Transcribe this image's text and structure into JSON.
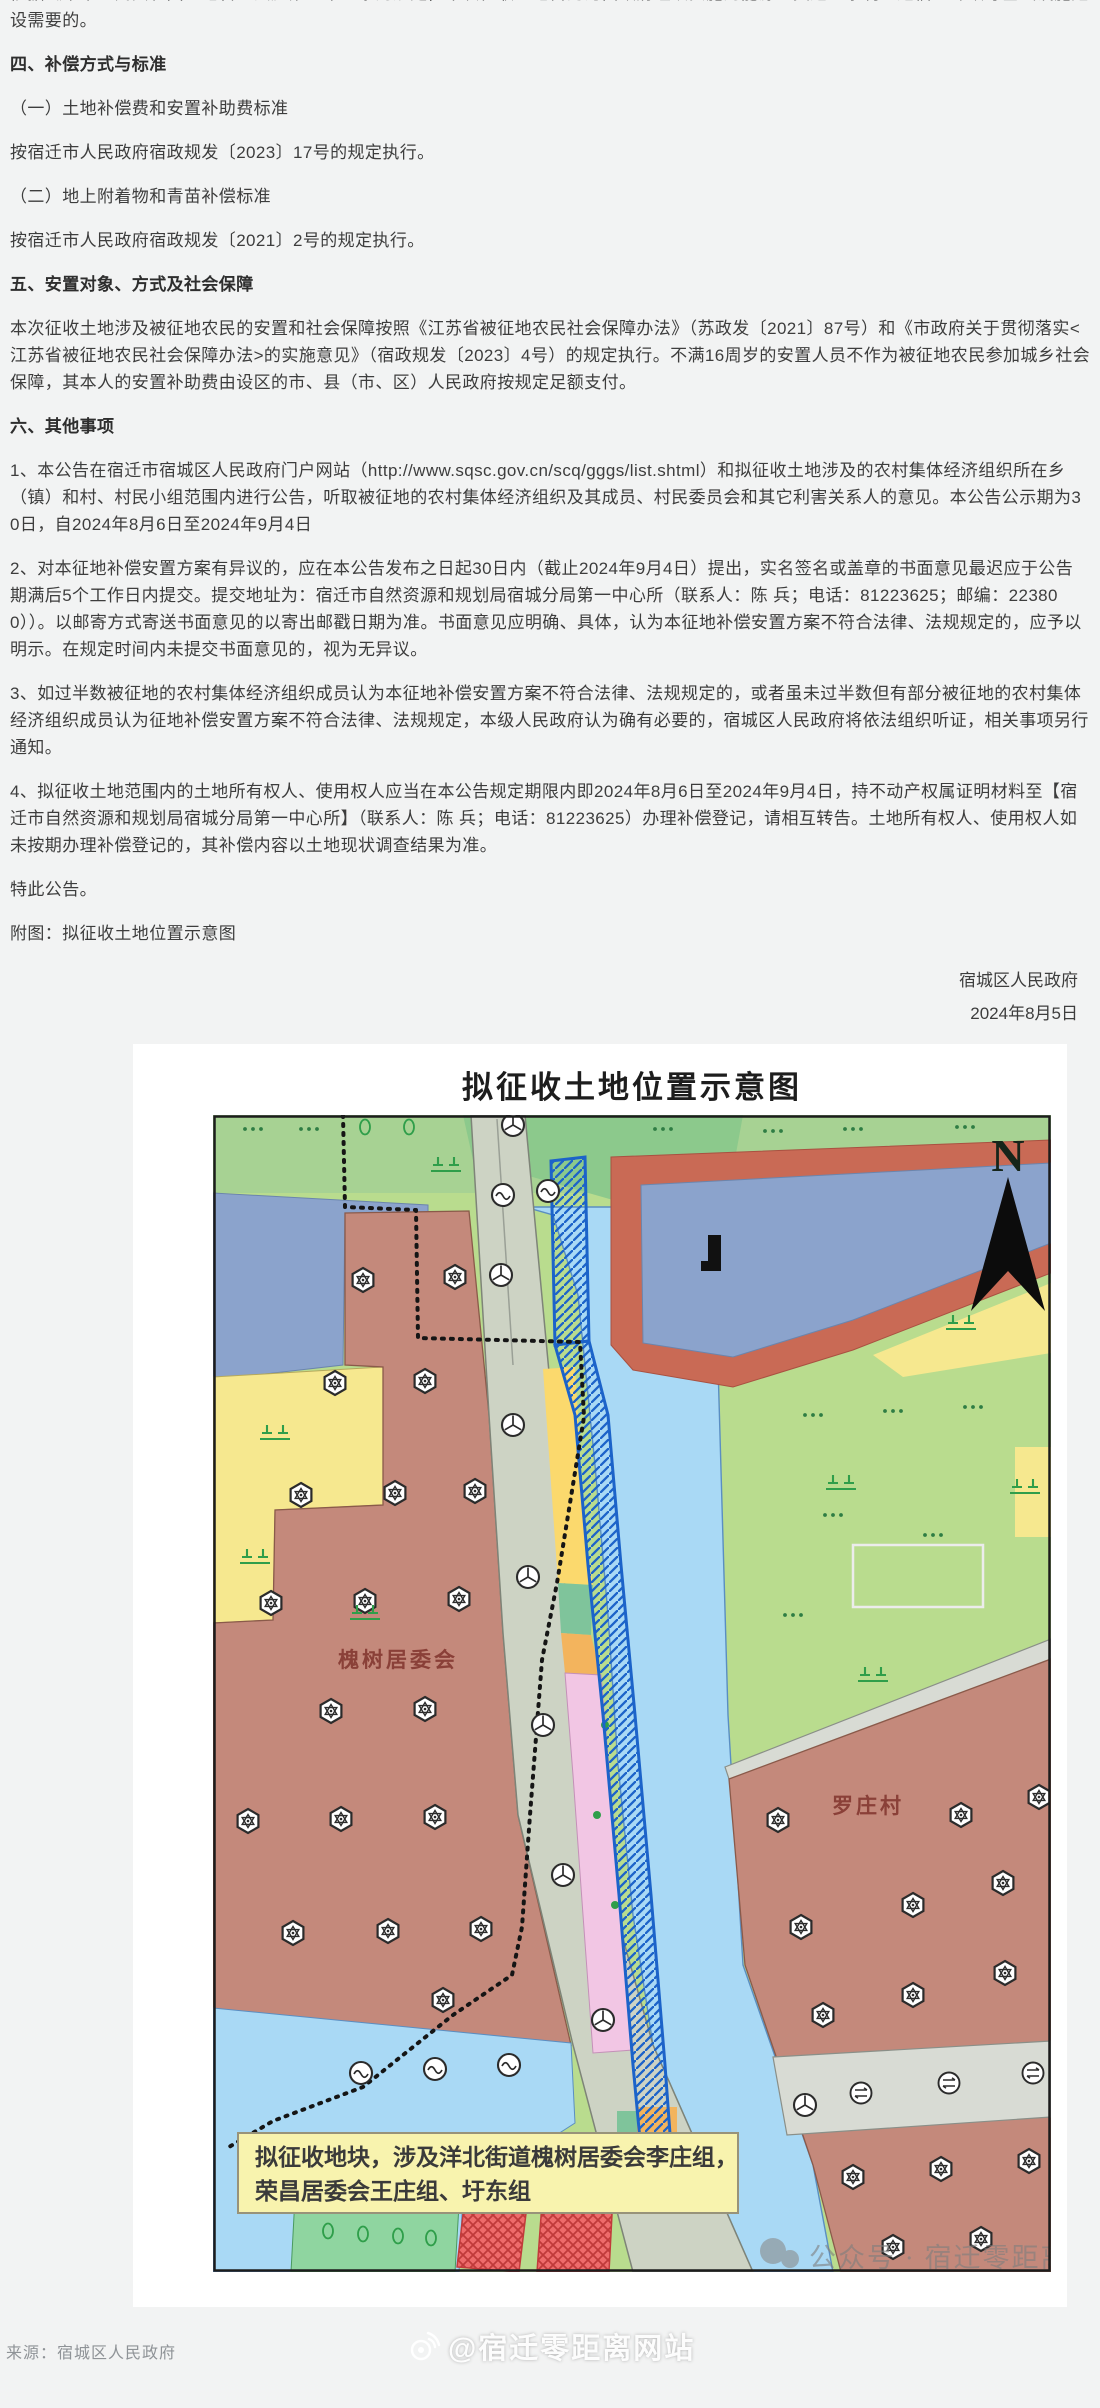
{
  "document": {
    "intro": "依据《中华人民共和国土地管理法》第四十五条的规定，本次征收土地目的为由政府组织实施的能源、交通、水利、通信、邮政等基础设施建设需要的。",
    "sections": [
      {
        "heading": "四、补偿方式与标准",
        "paragraphs": [
          "（一）土地补偿费和安置补助费标准",
          "按宿迁市人民政府宿政规发〔2023〕17号的规定执行。",
          "（二）地上附着物和青苗补偿标准",
          "按宿迁市人民政府宿政规发〔2021〕2号的规定执行。"
        ]
      },
      {
        "heading": "五、安置对象、方式及社会保障",
        "paragraphs": [
          "本次征收土地涉及被征地农民的安置和社会保障按照《江苏省被征地农民社会保障办法》（苏政发〔2021〕87号）和《市政府关于贯彻落实<江苏省被征地农民社会保障办法>的实施意见》（宿政规发〔2023〕4号）的规定执行。不满16周岁的安置人员不作为被征地农民参加城乡社会保障，其本人的安置补助费由设区的市、县（市、区）人民政府按规定足额支付。"
        ]
      },
      {
        "heading": "六、其他事项",
        "paragraphs": [
          "1、本公告在宿迁市宿城区人民政府门户网站（http://www.sqsc.gov.cn/scq/gggs/list.shtml）和拟征收土地涉及的农村集体经济组织所在乡（镇）和村、村民小组范围内进行公告，听取被征地的农村集体经济组织及其成员、村民委员会和其它利害关系人的意见。本公告公示期为30日，自2024年8月6日至2024年9月4日",
          "2、对本征地补偿安置方案有异议的，应在本公告发布之日起30日内（截止2024年9月4日）提出，实名签名或盖章的书面意见最迟应于公告期满后5个工作日内提交。提交地址为：宿迁市自然资源和规划局宿城分局第一中心所（联系人：陈 兵；电话：81223625；邮编：223800））。以邮寄方式寄送书面意见的以寄出邮戳日期为准。书面意见应明确、具体，认为本征地补偿安置方案不符合法律、法规规定的，应予以明示。在规定时间内未提交书面意见的，视为无异议。",
          "3、如过半数被征地的农村集体经济组织成员认为本征地补偿安置方案不符合法律、法规规定的，或者虽未过半数但有部分被征地的农村集体经济组织成员认为征地补偿安置方案不符合法律、法规规定，本级人民政府认为确有必要的，宿城区人民政府将依法组织听证，相关事项另行通知。",
          "4、拟征收土地范围内的土地所有权人、使用权人应当在本公告规定期限内即2024年8月6日至2024年9月4日，持不动产权属证明材料至【宿迁市自然资源和规划局宿城分局第一中心所】（联系人：陈 兵；电话：81223625）办理补偿登记，请相互转告。土地所有权人、使用权人如未按期办理补偿登记的，其补偿内容以土地现状调查结果为准。"
        ]
      }
    ],
    "closing": "特此公告。",
    "attachment_note": "附图：拟征收土地位置示意图",
    "signature": {
      "authority": "宿城区人民政府",
      "date": "2024年8月5日"
    }
  },
  "map": {
    "title": "拟征收土地位置示意图",
    "compass_label": "N",
    "labels": {
      "left_village": "槐树居委会",
      "right_village": "罗庄村"
    },
    "note_box": {
      "line1": "拟征收地块，涉及洋北街道槐树居委会李庄组，",
      "line2": "荣昌居委会王庄组、圩东组"
    },
    "watermark": "公众号 · 宿迁零距离",
    "colors": {
      "village_brown": "#c4897b",
      "road_olive": "#cdd3c4",
      "water_dark": "#8ba3cc",
      "water_light": "#a9d9f5",
      "green_light": "#b9dc8e",
      "yellow": "#f6e88f",
      "yellow_bright": "#fbd96d",
      "levee_red": "#c96a55",
      "red_parcel": "#ee6b6b",
      "pink": "#f2c6e4",
      "orange": "#f3b45d",
      "teal": "#7fc49b",
      "hatch_blue": "#1c63c9",
      "note_bg": "#f8f3ae"
    }
  },
  "footer": {
    "source": "来源：宿城区人民政府",
    "watermark": "@宿迁零距离网站"
  }
}
